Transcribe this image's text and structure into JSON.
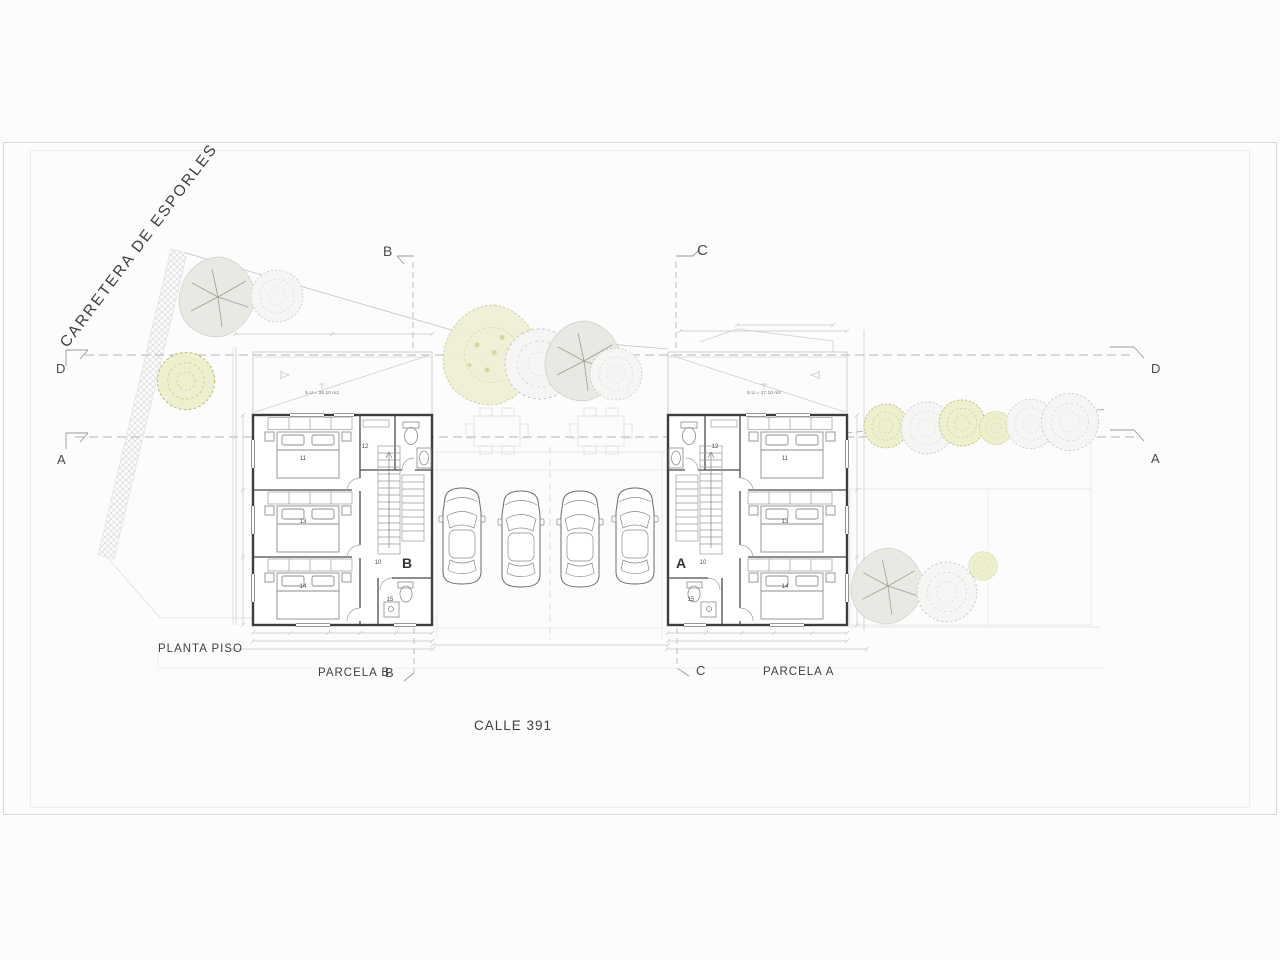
{
  "title_labels": {
    "road": "CARRETERA DE ESPORLES",
    "street": "CALLE 391",
    "plan": "PLANTA PISO",
    "parcel_b": "PARCELA B",
    "parcel_a": "PARCELA A"
  },
  "section_markers": {
    "b_top": "B",
    "c_top": "C",
    "d_left": "D",
    "a_left": "A",
    "d_right": "D",
    "a_right": "A",
    "b_bottom": "B",
    "c_bottom": "C",
    "b_plan": "B",
    "a_plan": "A"
  },
  "house_b": {
    "terrace_area": "S.U.= 26.10 m2",
    "rooms": {
      "r11": "11",
      "r12": "12",
      "r13": "13",
      "r14": "14",
      "r10": "10",
      "r15": "15"
    }
  },
  "house_a": {
    "terrace_area": "S.U.= 17.10 m2",
    "rooms": {
      "r11": "11",
      "r12": "12",
      "r13": "13",
      "r14": "14",
      "r10": "10",
      "r15": "15"
    }
  },
  "colors": {
    "wall": "#3d3d3d",
    "fixture": "#8a8a8a",
    "dimension": "#c6c6c6",
    "tree_gray_fill": "#e6e8e1",
    "tree_olive_fill": "#eeefce",
    "tree_olive_stroke": "#b8b96b",
    "text": "#3f3f3f"
  }
}
